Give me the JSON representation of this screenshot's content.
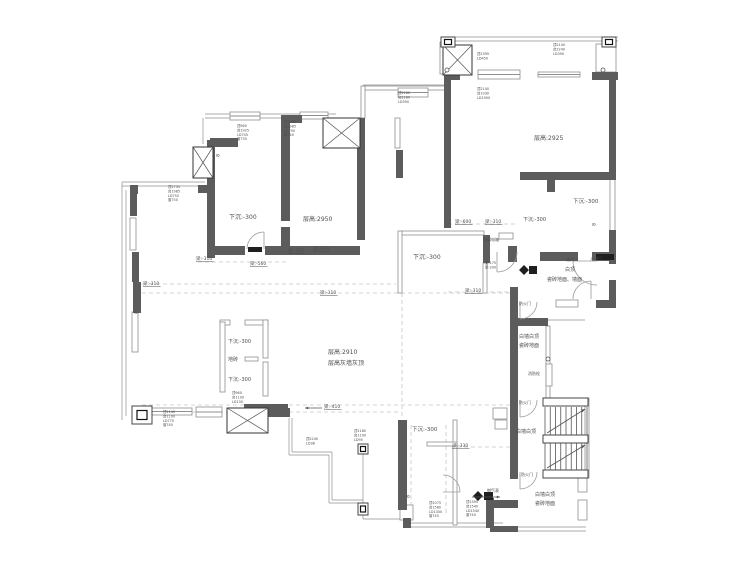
{
  "meta": {
    "type": "architectural-floor-plan",
    "description": "original structure floor plan with ceiling heights and beam drops",
    "colors": {
      "wall": "#5c5c5c",
      "black": "#1f1f1f",
      "thin_stroke": "#8f8f8f",
      "dash": "#c6c6c6",
      "text": "#4d4d4d",
      "bg": "#ffffff"
    }
  },
  "plan": {
    "labels": [
      {
        "n": "room-label-sunken-1",
        "t": "下沉:-300",
        "x": 229,
        "y": 219,
        "s": 6
      },
      {
        "n": "room-label-height-2950",
        "t": "层高:2950",
        "x": 303,
        "y": 221,
        "s": 6
      },
      {
        "n": "room-label-height-2925",
        "t": "层高:2925",
        "x": 534,
        "y": 140,
        "s": 6
      },
      {
        "n": "room-label-sunken-2",
        "t": "下沉:-300",
        "x": 573,
        "y": 203,
        "s": 5.5
      },
      {
        "n": "room-label-sunken-3",
        "t": "下沉:-300",
        "x": 523,
        "y": 221,
        "s": 5
      },
      {
        "n": "room-label-sunken-4",
        "t": "下沉:-300",
        "x": 413,
        "y": 259,
        "s": 6
      },
      {
        "n": "room-label-height-2910",
        "t": "层高:2910",
        "x": 328,
        "y": 354,
        "s": 6
      },
      {
        "n": "room-label-grey-wall",
        "t": "层高灰墙灰顶",
        "x": 328,
        "y": 365,
        "s": 6
      },
      {
        "n": "closet-label-sunken-a",
        "t": "下沉:-300",
        "x": 228,
        "y": 343,
        "s": 5
      },
      {
        "n": "closet-label-floortile",
        "t": "地砖",
        "x": 228,
        "y": 361,
        "s": 5
      },
      {
        "n": "closet-label-sunken-b",
        "t": "下沉:-300",
        "x": 228,
        "y": 381,
        "s": 5
      },
      {
        "n": "room-label-sunken-5",
        "t": "下沉:-300",
        "x": 412,
        "y": 431,
        "s": 5.5
      },
      {
        "n": "entry-label-ceiling",
        "t": "白顶",
        "x": 565,
        "y": 271,
        "s": 5
      },
      {
        "n": "entry-label-tile",
        "t": "瓷砖地面、墙面",
        "x": 547,
        "y": 281,
        "s": 5
      },
      {
        "n": "lobby-label-1a",
        "t": "白墙白顶",
        "x": 519,
        "y": 338,
        "s": 5
      },
      {
        "n": "lobby-label-1b",
        "t": "瓷砖地面",
        "x": 519,
        "y": 347,
        "s": 5
      },
      {
        "n": "lobby-label-2",
        "t": "白墙白顶",
        "x": 516,
        "y": 433,
        "s": 5
      },
      {
        "n": "lobby-label-3a",
        "t": "白墙白顶",
        "x": 535,
        "y": 496,
        "s": 5
      },
      {
        "n": "lobby-label-3b",
        "t": "瓷砖地面",
        "x": 535,
        "y": 505,
        "s": 5
      },
      {
        "n": "gas-meter-label",
        "t": "燃气表",
        "x": 487,
        "y": 492,
        "s": 4
      },
      {
        "n": "fire-hydrant-label",
        "t": "消防栓",
        "x": 528,
        "y": 375,
        "s": 4
      },
      {
        "n": "fire-door-label-1",
        "t": "防火门",
        "x": 519,
        "y": 305,
        "s": 4
      },
      {
        "n": "fire-door-label-2",
        "t": "防火门",
        "x": 519,
        "y": 404,
        "s": 4
      },
      {
        "n": "fire-door-label-3",
        "t": "防火门",
        "x": 521,
        "y": 476,
        "s": 4
      },
      {
        "n": "vent-label",
        "t": "通风口",
        "x": 566,
        "y": 261,
        "s": 4
      },
      {
        "n": "entry-door-label",
        "t": "入户门",
        "x": 590,
        "y": 260,
        "s": 4
      },
      {
        "n": "elec-box-label",
        "t": "强弱电箱",
        "x": 483,
        "y": 241,
        "s": 4
      },
      {
        "n": "beam-310-a",
        "t": "梁:-310",
        "x": 196,
        "y": 260,
        "s": 4.5,
        "u": 1
      },
      {
        "n": "beam-560",
        "t": "梁:-560",
        "x": 250,
        "y": 265,
        "s": 4.5,
        "u": 1
      },
      {
        "n": "beam-250",
        "t": "梁:-250",
        "x": 288,
        "y": 252,
        "s": 4.5,
        "u": 1
      },
      {
        "n": "beam-290",
        "t": "梁:-290",
        "x": 313,
        "y": 250,
        "s": 4.5,
        "u": 1
      },
      {
        "n": "beam-600",
        "t": "梁:-600",
        "x": 455,
        "y": 223,
        "s": 4.5,
        "u": 1
      },
      {
        "n": "beam-310-b",
        "t": "梁:-310",
        "x": 485,
        "y": 223,
        "s": 4.5,
        "u": 1
      },
      {
        "n": "beam-310-c",
        "t": "梁:-310",
        "x": 143,
        "y": 285,
        "s": 4.5,
        "u": 1
      },
      {
        "n": "beam-310-d",
        "t": "梁:-310",
        "x": 320,
        "y": 294,
        "s": 4.5,
        "u": 1
      },
      {
        "n": "beam-310-e",
        "t": "梁:-310",
        "x": 465,
        "y": 292,
        "s": 4.5,
        "u": 1
      },
      {
        "n": "beam-410",
        "t": "梁:-410",
        "x": 324,
        "y": 408,
        "s": 4.5,
        "u": 1
      },
      {
        "n": "beam-330",
        "t": "梁:-330",
        "x": 452,
        "y": 447,
        "s": 4.5,
        "u": 1
      },
      {
        "n": "hinge-mark-1",
        "t": "8",
        "x": 216,
        "y": 154,
        "s": 4.5,
        "rot": 90
      },
      {
        "n": "hinge-mark-2",
        "t": "8",
        "x": 592,
        "y": 223,
        "s": 4.5,
        "rot": 90
      },
      {
        "n": "hinge-mark-3",
        "t": "8",
        "x": 406,
        "y": 495,
        "s": 4.5,
        "rot": 90
      },
      {
        "n": "hinge-mark-4",
        "t": "8",
        "x": 134,
        "y": 311,
        "s": 4.5,
        "rot": 90
      }
    ],
    "annots": [
      {
        "n": "window-note",
        "x": 237,
        "y": 127,
        "lines": [
          "顶960",
          "台1925",
          "LD745",
          "窗735"
        ]
      },
      {
        "n": "window-note",
        "x": 284,
        "y": 123,
        "lines": [
          "顶2276",
          "台1985",
          "LD790",
          "窗740"
        ]
      },
      {
        "n": "window-note",
        "x": 168,
        "y": 188,
        "lines": [
          "顶1735",
          "台1985",
          "LD750",
          "窗750"
        ]
      },
      {
        "n": "window-note",
        "x": 477,
        "y": 90,
        "lines": [
          "顶2140",
          "台1930",
          "LD1900"
        ]
      },
      {
        "n": "window-note",
        "x": 553,
        "y": 46,
        "lines": [
          "顶2140",
          "台2240",
          "LD390"
        ]
      },
      {
        "n": "window-note",
        "x": 477,
        "y": 55,
        "lines": [
          "顶1395",
          "LD450"
        ]
      },
      {
        "n": "window-note",
        "x": 398,
        "y": 94,
        "lines": [
          "顶2280",
          "台2180",
          "LD390"
        ]
      },
      {
        "n": "window-note",
        "x": 232,
        "y": 394,
        "lines": [
          "顶960",
          "台1100",
          "LD130"
        ]
      },
      {
        "n": "window-note",
        "x": 163,
        "y": 413,
        "lines": [
          "顶1140",
          "台1100",
          "LD770",
          "窗740"
        ]
      },
      {
        "n": "window-note",
        "x": 429,
        "y": 504,
        "lines": [
          "顶1075",
          "台1580",
          "LD1300",
          "窗745"
        ]
      },
      {
        "n": "window-note",
        "x": 466,
        "y": 503,
        "lines": [
          "顶1395",
          "台1540",
          "LD1540",
          "窗740"
        ]
      },
      {
        "n": "window-note",
        "x": 354,
        "y": 432,
        "lines": [
          "顶1180",
          "台1100",
          "LD95"
        ]
      },
      {
        "n": "window-note",
        "x": 306,
        "y": 440,
        "lines": [
          "顶2240",
          "LD38"
        ]
      },
      {
        "n": "beam-note",
        "x": 485,
        "y": 264,
        "lines": [
          "梁-175",
          "梁-200"
        ]
      }
    ],
    "walls": [
      [
        444,
        72,
        16,
        8
      ],
      [
        592,
        72,
        26,
        8
      ],
      [
        444,
        78,
        7,
        150
      ],
      [
        609,
        74,
        7,
        104
      ],
      [
        520,
        172,
        96,
        8
      ],
      [
        547,
        178,
        8,
        14
      ],
      [
        609,
        230,
        7,
        34
      ],
      [
        540,
        252,
        38,
        9
      ],
      [
        592,
        252,
        24,
        9
      ],
      [
        596,
        300,
        20,
        8
      ],
      [
        609,
        280,
        7,
        28
      ],
      [
        510,
        287,
        8,
        192
      ],
      [
        518,
        318,
        30,
        8
      ],
      [
        207,
        140,
        8,
        118
      ],
      [
        210,
        138,
        28,
        9
      ],
      [
        281,
        115,
        9,
        106
      ],
      [
        281,
        227,
        9,
        28
      ],
      [
        213,
        246,
        32,
        9
      ],
      [
        265,
        246,
        17,
        9
      ],
      [
        281,
        246,
        79,
        9
      ],
      [
        290,
        115,
        12,
        8
      ],
      [
        357,
        118,
        8,
        122
      ],
      [
        396,
        150,
        7,
        28
      ],
      [
        483,
        235,
        7,
        28
      ],
      [
        508,
        246,
        9,
        16
      ],
      [
        130,
        185,
        8,
        9
      ],
      [
        198,
        185,
        9,
        8
      ],
      [
        130,
        192,
        7,
        24
      ],
      [
        132,
        252,
        7,
        30
      ],
      [
        133,
        282,
        8,
        31
      ],
      [
        268,
        408,
        22,
        9
      ],
      [
        244,
        404,
        44,
        7
      ],
      [
        398,
        420,
        9,
        90
      ],
      [
        403,
        518,
        8,
        10
      ],
      [
        486,
        498,
        8,
        30
      ],
      [
        492,
        500,
        26,
        8
      ],
      [
        490,
        526,
        28,
        6
      ]
    ],
    "thin": [
      [
        440,
        42,
        5,
        32
      ],
      [
        596,
        44,
        20,
        28
      ],
      [
        610,
        178,
        5,
        84
      ],
      [
        363,
        86,
        82,
        4
      ],
      [
        361,
        86,
        4,
        32
      ],
      [
        400,
        231,
        84,
        4
      ],
      [
        398,
        231,
        4,
        62
      ],
      [
        483,
        263,
        4,
        30
      ],
      [
        499,
        233,
        14,
        6
      ],
      [
        546,
        326,
        4,
        72
      ],
      [
        546,
        364,
        6,
        22
      ],
      [
        556,
        300,
        22,
        7
      ],
      [
        585,
        398,
        4,
        80
      ],
      [
        578,
        478,
        9,
        14
      ],
      [
        578,
        500,
        9,
        20
      ],
      [
        220,
        320,
        10,
        5
      ],
      [
        245,
        320,
        23,
        5
      ],
      [
        220,
        322,
        5,
        70
      ],
      [
        263,
        320,
        5,
        38
      ],
      [
        245,
        357,
        13,
        4
      ],
      [
        263,
        362,
        5,
        34
      ],
      [
        453,
        420,
        4,
        105
      ],
      [
        427,
        442,
        30,
        4
      ],
      [
        400,
        505,
        13,
        15
      ],
      [
        493,
        408,
        14,
        11
      ],
      [
        495,
        420,
        12,
        9
      ],
      [
        395,
        118,
        5,
        30
      ],
      [
        132,
        312,
        6,
        40
      ],
      [
        130,
        218,
        6,
        32
      ]
    ],
    "windows": [
      [
        478,
        70,
        42,
        9
      ],
      [
        538,
        72,
        42,
        5
      ],
      [
        398,
        88,
        30,
        9
      ],
      [
        230,
        112,
        30,
        8
      ],
      [
        300,
        112,
        28,
        7
      ],
      [
        196,
        407,
        26,
        10
      ],
      [
        152,
        408,
        40,
        7
      ]
    ],
    "shafts": [
      [
        193,
        147,
        20,
        31
      ],
      [
        323,
        118,
        37,
        30
      ],
      [
        443,
        45,
        29,
        30
      ],
      [
        227,
        408,
        41,
        25
      ]
    ],
    "cboxes": [
      [
        132,
        406,
        20,
        18
      ],
      [
        441,
        37,
        14,
        10
      ],
      [
        602,
        37,
        14,
        10
      ],
      [
        358,
        444,
        10,
        10
      ],
      [
        358,
        503,
        10,
        12
      ]
    ],
    "lines": [
      [
        443,
        37,
        618,
        37
      ],
      [
        443,
        41,
        618,
        41
      ],
      [
        205,
        114,
        336,
        114
      ],
      [
        205,
        118,
        336,
        118
      ],
      [
        203,
        118,
        203,
        144
      ],
      [
        363,
        85,
        445,
        85
      ],
      [
        122,
        182,
        205,
        182
      ],
      [
        122,
        186,
        201,
        186
      ],
      [
        122,
        182,
        122,
        420
      ],
      [
        126,
        190,
        126,
        416
      ],
      [
        292,
        418,
        292,
        452
      ],
      [
        292,
        452,
        332,
        452
      ],
      [
        332,
        452,
        332,
        500
      ],
      [
        332,
        500,
        363,
        500
      ],
      [
        289,
        418,
        289,
        455
      ],
      [
        289,
        455,
        329,
        455
      ],
      [
        329,
        455,
        329,
        503
      ],
      [
        329,
        503,
        360,
        503
      ],
      [
        363,
        446,
        363,
        519
      ],
      [
        363,
        519,
        403,
        519
      ],
      [
        403,
        523,
        503,
        523
      ],
      [
        403,
        527,
        503,
        527
      ],
      [
        518,
        527,
        586,
        527
      ],
      [
        518,
        531,
        586,
        531
      ],
      [
        548,
        320,
        585,
        320
      ]
    ],
    "dashed": [
      [
        198,
        262,
        288,
        262
      ],
      [
        290,
        252,
        358,
        252
      ],
      [
        448,
        224,
        516,
        224
      ],
      [
        142,
        284,
        396,
        284
      ],
      [
        142,
        293,
        515,
        293
      ],
      [
        448,
        292,
        516,
        292
      ],
      [
        142,
        405,
        515,
        405
      ],
      [
        142,
        412,
        398,
        412
      ],
      [
        457,
        447,
        512,
        447
      ],
      [
        402,
        293,
        402,
        418
      ],
      [
        411,
        425,
        411,
        515
      ],
      [
        446,
        425,
        446,
        515
      ]
    ],
    "doors": [
      {
        "cx": 264,
        "cy": 249,
        "r": 17,
        "a0": 90,
        "a1": 180
      },
      {
        "cx": 597,
        "cy": 261,
        "r": 24,
        "a0": 180,
        "a1": 270
      },
      {
        "cx": 497,
        "cy": 252,
        "r": 20,
        "a0": 270,
        "a1": 360
      },
      {
        "cx": 591,
        "cy": 299,
        "r": 18,
        "a0": 90,
        "a1": 180
      },
      {
        "cx": 520,
        "cy": 302,
        "r": 17,
        "a0": 270,
        "a1": 360
      },
      {
        "cx": 520,
        "cy": 400,
        "r": 17,
        "a0": 270,
        "a1": 360
      },
      {
        "cx": 520,
        "cy": 472,
        "r": 17,
        "a0": 270,
        "a1": 360
      },
      {
        "cx": 443,
        "cy": 492,
        "r": 17,
        "a0": 0,
        "a1": 90
      }
    ],
    "leafs": [
      [
        596,
        254,
        18,
        6
      ],
      [
        248,
        247,
        14,
        5
      ],
      [
        484,
        492,
        9,
        8
      ],
      [
        529,
        266,
        8,
        8
      ]
    ],
    "diamonds": [
      {
        "x": 478,
        "y": 496,
        "s": 7
      },
      {
        "x": 524,
        "y": 270,
        "s": 7
      }
    ],
    "arrows": [
      {
        "x1": 322,
        "y1": 408,
        "x2": 305,
        "y2": 408
      },
      {
        "x1": 472,
        "y1": 497,
        "x2": 500,
        "y2": 497
      }
    ],
    "circles": [
      [
        447,
        70
      ],
      [
        603,
        70
      ],
      [
        548,
        359
      ]
    ],
    "stairs": {
      "bars": [
        [
          543,
          398,
          45,
          8
        ],
        [
          543,
          435,
          45,
          8
        ],
        [
          543,
          470,
          45,
          8
        ]
      ],
      "flights": [
        {
          "x": 545,
          "y": 407,
          "w": 42,
          "h": 28,
          "n": 8
        },
        {
          "x": 545,
          "y": 443,
          "w": 42,
          "h": 27,
          "n": 8
        }
      ],
      "diagonals": [
        [
          547,
          433,
          585,
          409
        ],
        [
          547,
          468,
          585,
          445
        ]
      ]
    }
  }
}
